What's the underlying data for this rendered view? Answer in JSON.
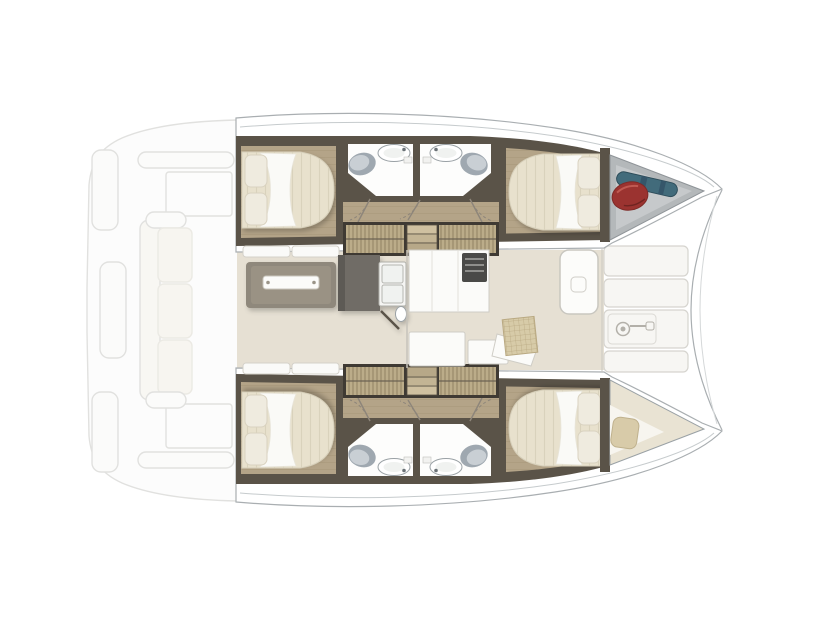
{
  "description": "Catamaran interior deck plan, bow pointing right, two hulls with cabins and heads, central saloon with galley, faded aft cockpit",
  "palette": {
    "background": "#ffffff",
    "hull_white": "#ffffff",
    "hull_line": "#a9aeb1",
    "deck_line": "#c6cbcd",
    "wall_dark": "#5a5348",
    "wood_floor": "#b4a488",
    "mattress": "#e8e1cd",
    "duvet": "#fafaf7",
    "pillow": "#efebdf",
    "mat": "#c6b791",
    "mat_frame": "#3f3a33",
    "step_light": "#cfc0a0",
    "step_mid": "#c3b494",
    "step_dark": "#b7a888",
    "bath_floor": "#fdfdfc",
    "fixture_dark": "#9fa8b0",
    "fixture_light": "#c9cfd4",
    "saloon_floor": "#e6e0d3",
    "bench": "#fafaf8",
    "table": "#8f887b",
    "table_top": "#9a9284",
    "tray": "#fbfbf9",
    "counter": "#6f6c66",
    "sink_white": "#f5f5f3",
    "sink_inner": "#f0f2f0",
    "stove": "#4a4a48",
    "cabinet": "#fbfbf9",
    "check_mat": "#d7cba8",
    "deck_panel": "#f7f6f3",
    "bow_storage": "#b4b8ba",
    "bow_storage_hi": "#c6c9cb",
    "fender_red": "#9b3330",
    "gear_teal": "#426b7b",
    "berth_floor": "#e9e3d3",
    "berth_white": "#f7f5ef",
    "berth_pillow": "#d8cba9",
    "cockpit_fill": "#f9f9f7",
    "cockpit_line": "#c9c9c6",
    "cockpit_cushion": "#f1eee5"
  },
  "objects": {
    "hulls": [
      "starboard-hull",
      "port-hull"
    ],
    "per_hull": [
      "aft-cabin-double-bed",
      "two-head-compartments",
      "toilet",
      "washbasin",
      "companionway-steps",
      "woven-mats",
      "forward-cabin-double-bed"
    ],
    "bow_items": [
      "storage-locker-with-fender-and-gear",
      "forepeak-berth-with-pillow"
    ],
    "saloon": [
      "dining-table",
      "side-bench-cushions",
      "galley-sink-unit",
      "counter-with-stove",
      "cabinets",
      "chart-seat",
      "woven-check-mat",
      "foredeck-door"
    ],
    "foredeck": [
      "deck-panels",
      "windlass-hatch"
    ],
    "aft_cockpit": [
      "transom-steps",
      "aft-bench",
      "cockpit-sofa",
      "deck-lockers"
    ]
  }
}
